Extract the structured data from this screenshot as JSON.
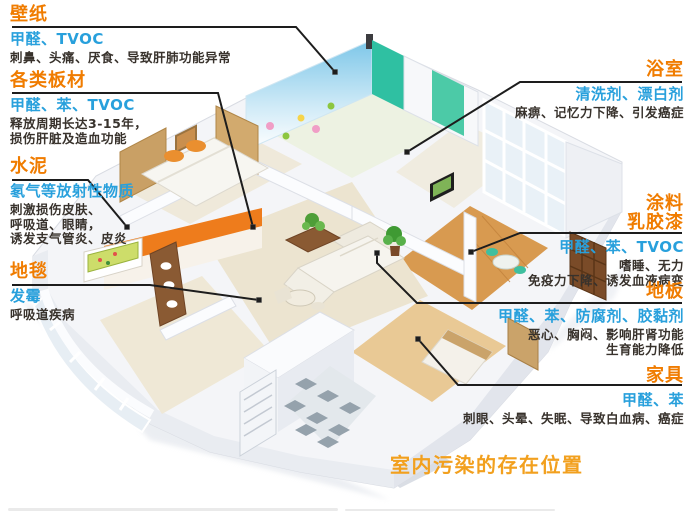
{
  "caption": "室内污染的存在位置",
  "colors": {
    "accent_orange": "#f07c00",
    "caption_orange": "#f2a01e",
    "pollutant_blue": "#28a0dc",
    "text_dark": "#38322c",
    "line_dark": "#1d1d1d"
  },
  "callouts": [
    {
      "id": "wallpaper",
      "title": "壁纸",
      "pollutants": "甲醛、TVOC",
      "effects": [
        "刺鼻、头痛、厌食、导致肝肺功能异常"
      ]
    },
    {
      "id": "boards",
      "title": "各类板材",
      "pollutants": "甲醛、苯、TVOC",
      "effects": [
        "释放周期长达3-15年，",
        "损伤肝脏及造血功能"
      ]
    },
    {
      "id": "cement",
      "title": "水泥",
      "pollutants": "氡气等放射性物质",
      "effects": [
        "刺激损伤皮肤、",
        "呼吸道、眼睛，",
        "诱发支气管炎、皮炎"
      ]
    },
    {
      "id": "carpet",
      "title": "地毯",
      "pollutants": "发霉",
      "effects": [
        "呼吸道疾病"
      ]
    },
    {
      "id": "bathroom",
      "title": "浴室",
      "pollutants": "清洗剂、漂白剂",
      "effects": [
        "麻痹、记忆力下降、引发癌症"
      ]
    },
    {
      "id": "paint",
      "title": "涂料",
      "title2": "乳胶漆",
      "pollutants": "甲醛、苯、TVOC",
      "effects": [
        "嗜睡、无力",
        "免疫力下降、诱发血液病变"
      ]
    },
    {
      "id": "floor",
      "title": "地板",
      "pollutants": "甲醛、苯、防腐剂、胶黏剂",
      "effects": [
        "恶心、胸闷、影响肝肾功能",
        "生育能力降低"
      ]
    },
    {
      "id": "furniture",
      "title": "家具",
      "pollutants": "甲醛、苯",
      "effects": [
        "刺眼、头晕、失眠、导致白血病、癌症"
      ]
    }
  ]
}
